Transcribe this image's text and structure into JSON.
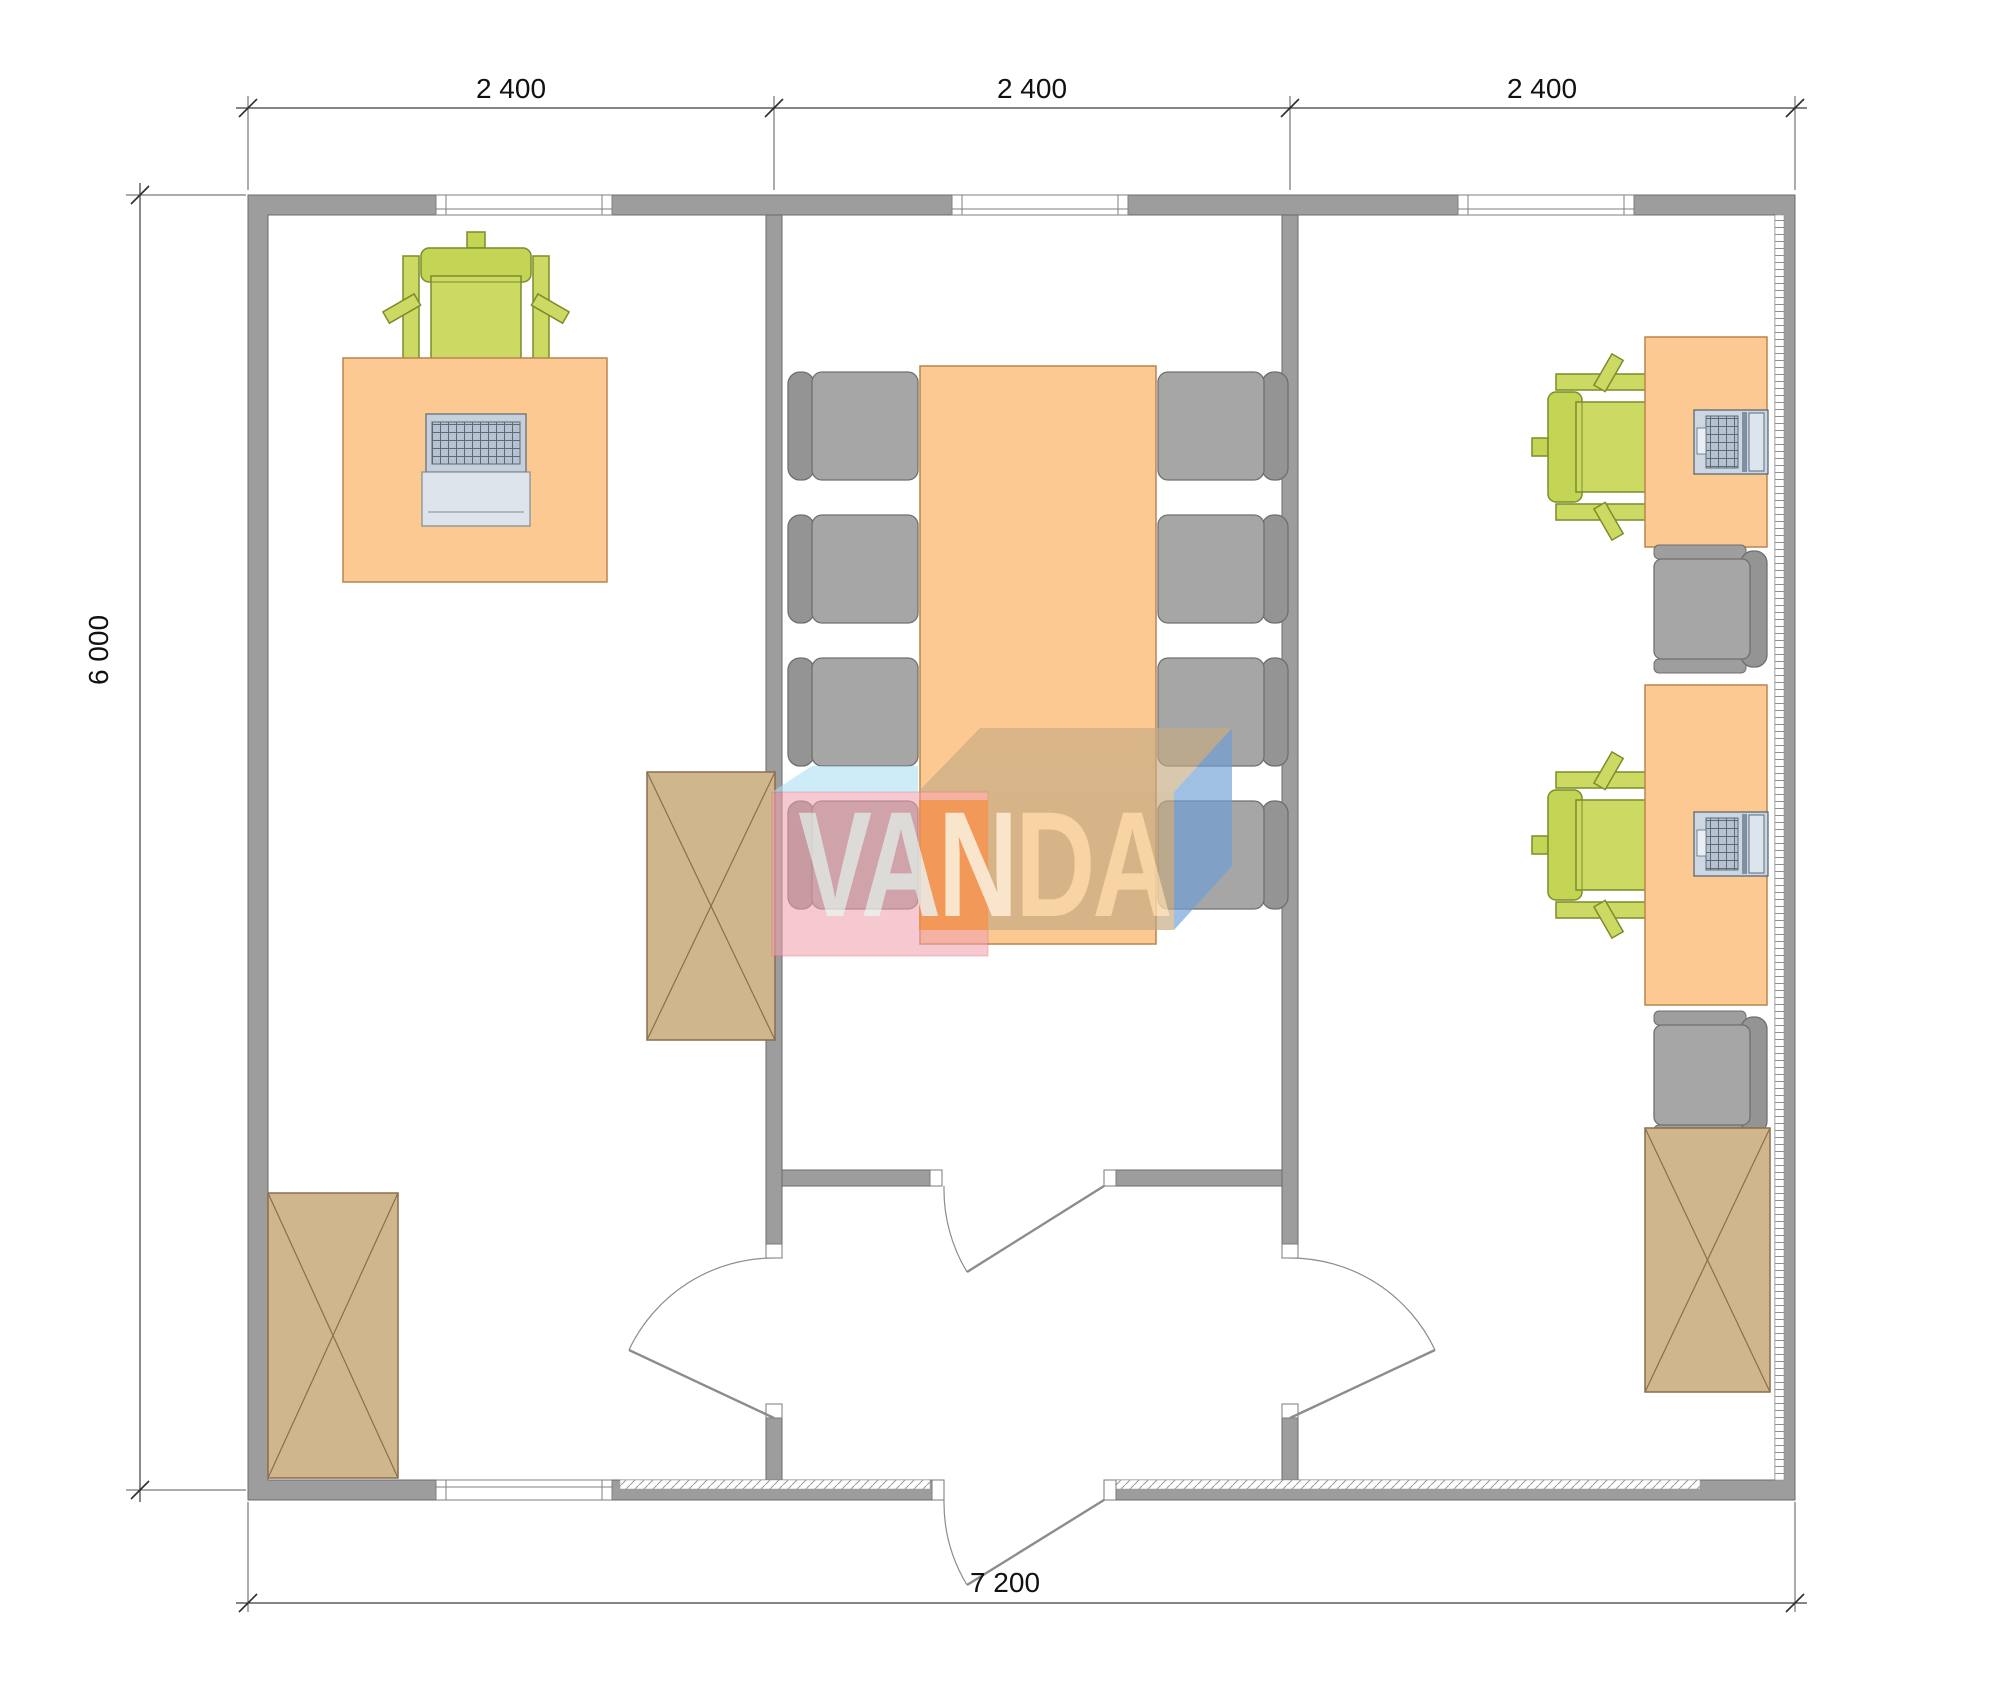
{
  "plan": {
    "top_dimensions": [
      "2 400",
      "2 400",
      "2 400"
    ],
    "left_dimension": "6 000",
    "bottom_dimension": "7 200",
    "watermark": {
      "text": "VANDA",
      "va": "VA",
      "n": "N",
      "da": "DA"
    }
  },
  "colors": {
    "wall": "#9d9d9d",
    "desk_orange": "#fcc992",
    "chair_green": "#ccda63",
    "chair_gray": "#a6a6a6",
    "cabinet_tan": "#cfb68c",
    "logo_pink": "#f0a0ac",
    "logo_orange": "#f08a3e",
    "logo_tan": "#c6ab83",
    "logo_blue": "#6d9fd6",
    "logo_skyblue": "#aee0f2"
  },
  "furniture_icons": {
    "left_office": [
      "office-desk-icon",
      "desk-chair-icon",
      "keyboard-tray-icon",
      "cabinet-x-icon",
      "cabinet-x-icon"
    ],
    "meeting_room": [
      "conference-table-icon",
      "conference-chair-icon x8"
    ],
    "right_office": [
      "office-desk-icon x2",
      "laptop-icon x2",
      "desk-chair-icon x2",
      "task-chair-icon x2",
      "cabinet-x-icon"
    ],
    "openings": [
      "window-icon x4",
      "swing-door-icon x4"
    ]
  }
}
